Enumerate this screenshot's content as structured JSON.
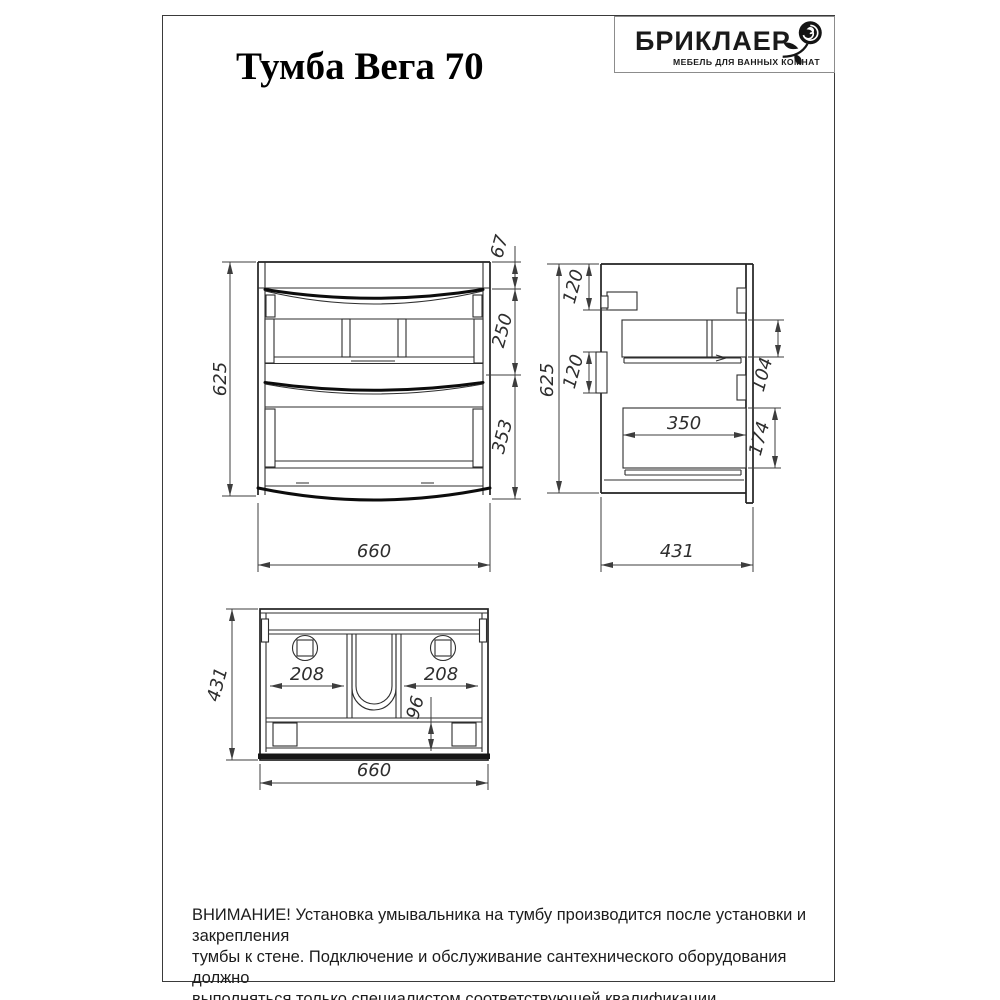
{
  "page": {
    "title": "Тумба Вега 70"
  },
  "logo": {
    "brand": "БРИКЛАЕР",
    "tagline": "МЕБЕЛЬ ДЛЯ ВАННЫХ КОМНАТ",
    "icon": "rose-icon"
  },
  "colors": {
    "line": "#2e2e2e",
    "dim_text": "#2e2e2e",
    "background": "#ffffff"
  },
  "views": {
    "front": {
      "name": "front-view",
      "dims": {
        "overall_height": "625",
        "top_section": "67",
        "upper_drawer": "250",
        "lower_drawer": "353",
        "overall_width": "660"
      }
    },
    "side": {
      "name": "side-view",
      "dims": {
        "overall_height": "625",
        "bracket_top_offset": "120",
        "bracket_mid_offset": "120",
        "upper_drawer_height": "104",
        "drawer_depth": "350",
        "lower_drawer_height": "174",
        "overall_depth": "431"
      }
    },
    "top": {
      "name": "top-view",
      "dims": {
        "overall_depth": "431",
        "left_compartment": "208",
        "right_compartment": "208",
        "back_section": "96",
        "overall_width": "660"
      }
    }
  },
  "warning": {
    "line1": "ВНИМАНИЕ! Установка умывальника на тумбу производится после установки и закрепления",
    "line2": "тумбы к стене. Подключение и обслуживание сантехнического оборудования должно",
    "line3": "выполняться только специалистом соответствующей квалификации."
  }
}
